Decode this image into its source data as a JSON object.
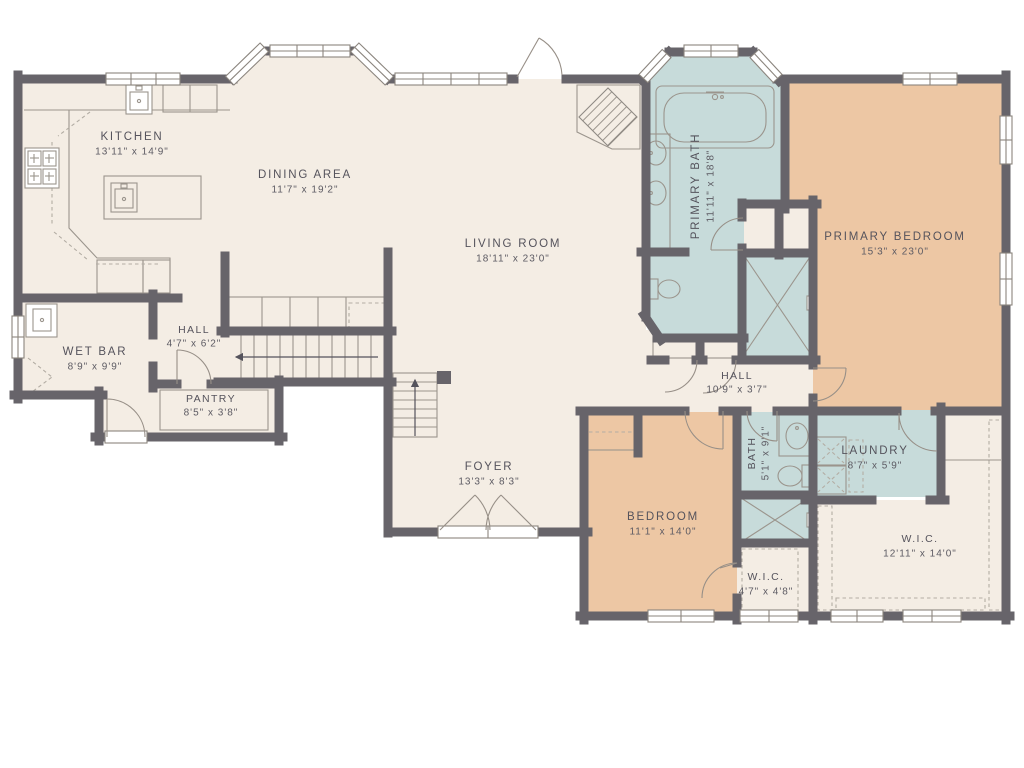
{
  "title": "Single-story house floor plan",
  "colors": {
    "background": "#ffffff",
    "floor_cream": "#f4ede4",
    "floor_tan": "#edc7a4",
    "floor_blue": "#c7dbda",
    "wall": "#67646a",
    "fixture_line": "#9b958d",
    "label_text": "#55535c"
  },
  "plan": {
    "rooms": {
      "kitchen": {
        "name": "KITCHEN",
        "dims": "13'11\" x 14'9\""
      },
      "dining": {
        "name": "DINING AREA",
        "dims": "11'7\" x 19'2\""
      },
      "living": {
        "name": "LIVING ROOM",
        "dims": "18'11\" x 23'0\""
      },
      "primary_bath": {
        "name": "PRIMARY BATH",
        "dims": "11'11\" x 18'8\""
      },
      "primary_bedroom": {
        "name": "PRIMARY BEDROOM",
        "dims": "15'3\" x 23'0\""
      },
      "wet_bar": {
        "name": "WET BAR",
        "dims": "8'9\" x 9'9\""
      },
      "hall1": {
        "name": "HALL",
        "dims": "4'7\" x 6'2\""
      },
      "pantry": {
        "name": "PANTRY",
        "dims": "8'5\" x 3'8\""
      },
      "foyer": {
        "name": "FOYER",
        "dims": "13'3\" x 8'3\""
      },
      "hall2": {
        "name": "HALL",
        "dims": "10'9\" x 3'7\""
      },
      "bedroom": {
        "name": "BEDROOM",
        "dims": "11'1\" x 14'0\""
      },
      "bath2": {
        "name": "BATH",
        "dims": "5'1\" x 9'1\""
      },
      "laundry": {
        "name": "LAUNDRY",
        "dims": "8'7\" x 5'9\""
      },
      "wic_small": {
        "name": "W.I.C.",
        "dims": "4'7\" x 4'8\""
      },
      "wic_large": {
        "name": "W.I.C.",
        "dims": "12'11\" x 14'0\""
      }
    },
    "fixtures": [
      "bathtub",
      "double-vanity-sinks",
      "toilet",
      "shower",
      "kitchen-island-sink",
      "cooktop",
      "wet-bar-sink",
      "washer-dryer",
      "fireplace",
      "stairs-up",
      "double-entry-door",
      "bay-windows"
    ]
  }
}
